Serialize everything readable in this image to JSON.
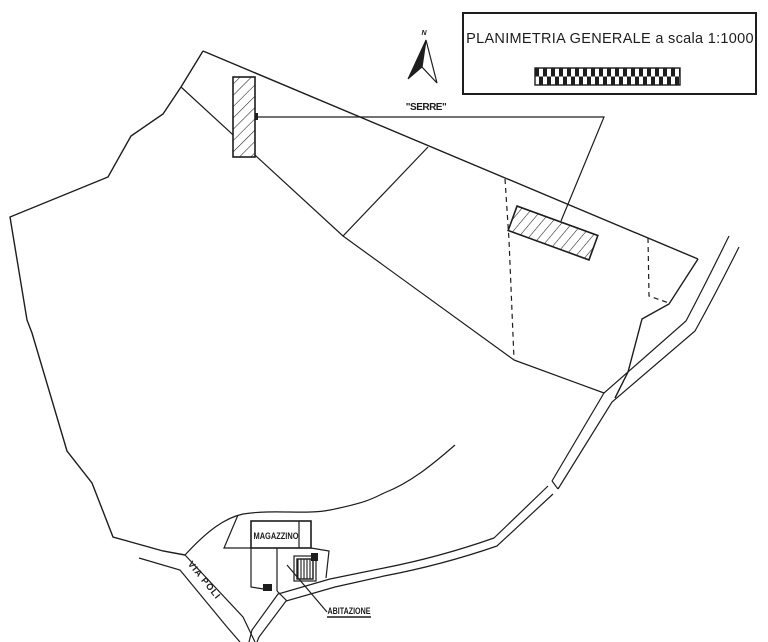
{
  "title_block": {
    "title": "PLANIMETRIA GENERALE a scala 1:1000"
  },
  "compass": {
    "north_label": "N"
  },
  "labels": {
    "greenhouses": "\"SERRE\"",
    "warehouse": "MAGAZZINO",
    "dwelling": "ABITAZIONE",
    "street": "VIA POLI"
  },
  "colors": {
    "ink": "#1d1d1d",
    "paper": "#ffffff"
  }
}
